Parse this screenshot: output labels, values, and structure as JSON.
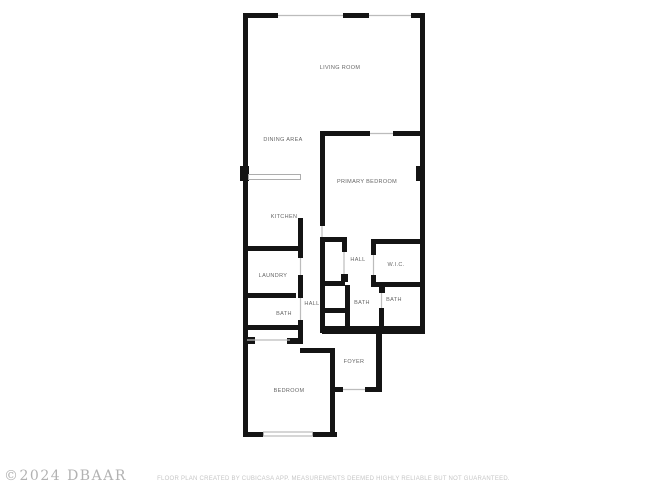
{
  "page": {
    "background_color": "#ffffff"
  },
  "floorplan": {
    "wall_color": "#141414",
    "opening_color": "#bcbcbc",
    "label_color": "#666666",
    "rooms": [
      {
        "id": "living-room",
        "label": "LIVING ROOM",
        "x": 340,
        "y": 68
      },
      {
        "id": "dining-area",
        "label": "DINING AREA",
        "x": 283,
        "y": 140
      },
      {
        "id": "primary-bedroom",
        "label": "PRIMARY BEDROOM",
        "x": 367,
        "y": 182
      },
      {
        "id": "kitchen",
        "label": "KITCHEN",
        "x": 284,
        "y": 217
      },
      {
        "id": "hall-upper",
        "label": "HALL",
        "x": 358,
        "y": 260
      },
      {
        "id": "wic",
        "label": "W.I.C.",
        "x": 396,
        "y": 265
      },
      {
        "id": "laundry",
        "label": "LAUNDRY",
        "x": 273,
        "y": 276
      },
      {
        "id": "bath-right",
        "label": "BATH",
        "x": 394,
        "y": 300
      },
      {
        "id": "hall-lower",
        "label": "HALL",
        "x": 312,
        "y": 304
      },
      {
        "id": "bath-center",
        "label": "BATH",
        "x": 362,
        "y": 303
      },
      {
        "id": "bath-left",
        "label": "BATH",
        "x": 284,
        "y": 314
      },
      {
        "id": "foyer",
        "label": "FOYER",
        "x": 354,
        "y": 362
      },
      {
        "id": "bedroom",
        "label": "BEDROOM",
        "x": 289,
        "y": 391
      }
    ]
  },
  "footer": {
    "watermark": "©2024 DBAAR",
    "disclaimer": "FLOOR PLAN CREATED BY CUBICASA APP. MEASUREMENTS DEEMED HIGHLY RELIABLE BUT NOT GUARANTEED."
  }
}
